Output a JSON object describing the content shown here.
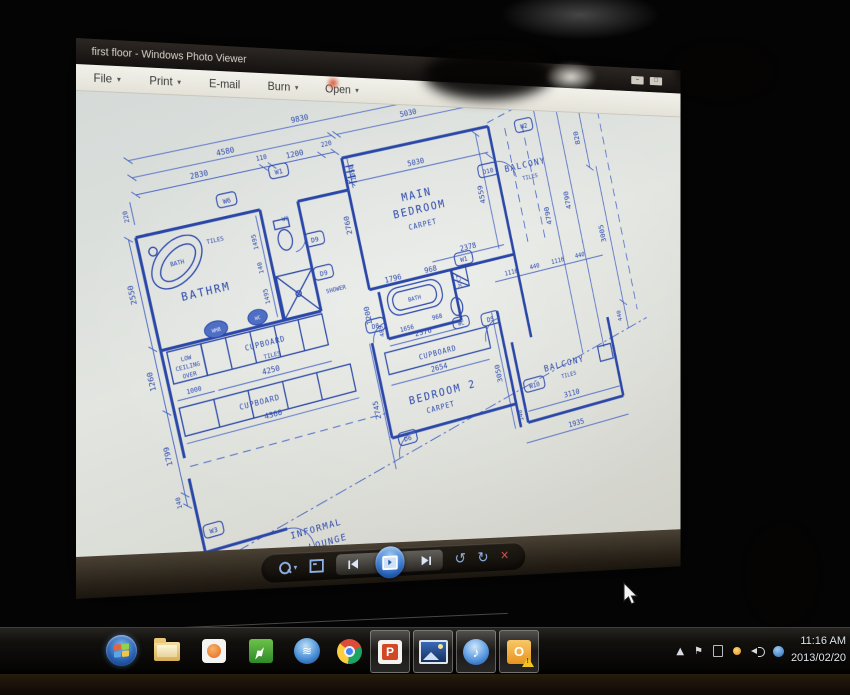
{
  "window": {
    "title": "first floor - Windows Photo Viewer",
    "minimize_glyph": "–",
    "maximize_glyph": "□",
    "menu": [
      {
        "label": "File"
      },
      {
        "label": "Print"
      },
      {
        "label": "E-mail"
      },
      {
        "label": "Burn"
      },
      {
        "label": "Open"
      }
    ],
    "menu_caret": "▾"
  },
  "viewer_toolbar": {
    "zoom_caret": "▾",
    "rotate_ccw_glyph": "↺",
    "rotate_cw_glyph": "↻",
    "delete_glyph": "✕"
  },
  "plan": {
    "rooms": {
      "bathrm": "BATHRM",
      "main1": "MAIN",
      "main2": "BEDROOM",
      "bedroom2": "BEDROOM 2",
      "balcony": "BALCONY",
      "informal1": "INFORMAL",
      "informal2": "LOUNGE"
    },
    "surfaces": {
      "tiles": "TILES",
      "carpet": "CARPET"
    },
    "features": {
      "bath": "BATH",
      "shower": "SHOWER",
      "wc": "WC",
      "whb": "WHB",
      "duct": "DUCT",
      "cupboard": "CUPBOARD",
      "low": "LOW",
      "ceiling": "CEILING",
      "over": "OVER"
    },
    "tags": {
      "w1": "W1",
      "w2": "W2",
      "w3": "W3",
      "w6": "W6",
      "w10": "W10",
      "d5": "D5",
      "d6": "D6",
      "d8": "D8",
      "d9": "D9",
      "d10": "D10",
      "wc": "WC"
    },
    "dims": {
      "d9830": "9830",
      "d5030t": "5030",
      "d4580": "4580",
      "d2830": "2830",
      "d110": "110",
      "d1200t": "1200",
      "d220a": "220",
      "d220b": "220",
      "d1050": "1050",
      "d2550": "2550",
      "d1260": "1260",
      "d1799": "1799",
      "d140a": "140",
      "d4790a": "4790",
      "d4790b": "4790",
      "d820": "820",
      "d3005": "3005",
      "d440r": "440",
      "d1935": "1935",
      "d3110": "3110",
      "d5030i": "5030",
      "d2760": "2760",
      "d4559": "4559",
      "d2378": "2378",
      "d1796": "1796",
      "d968a": "968",
      "d1200i": "1200",
      "d2376": "2376",
      "d1116a": "1116",
      "d440a": "440",
      "d1116b": "1116",
      "d440b": "440",
      "d1656": "1656",
      "d968b": "968",
      "d489": "489",
      "d4250": "4250",
      "d1000": "1000",
      "d4360": "4360",
      "d2654": "2654",
      "d3050": "3050",
      "d2745": "2745",
      "d1495a": "1495",
      "d140b": "140",
      "d1495b": "1495",
      "d140c": "140"
    }
  },
  "taskbar": {
    "tray_expand": "▲",
    "tray_flag": "⚑",
    "network_glyph": "≋",
    "itunes_glyph": "♪",
    "outlook_glyph": "O",
    "ppt_glyph": "P",
    "clock_time": "11:16 AM",
    "clock_date": "2013/02/20"
  }
}
